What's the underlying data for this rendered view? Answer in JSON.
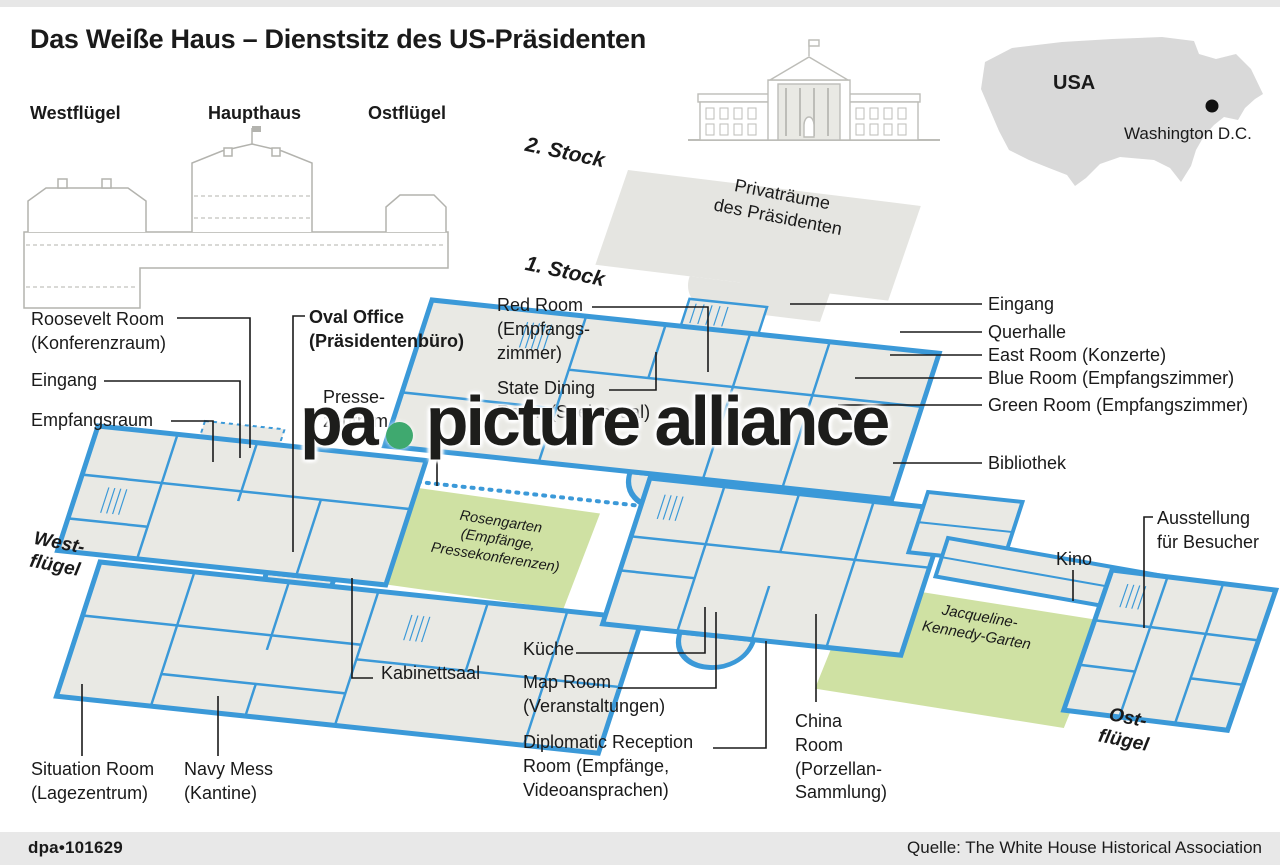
{
  "header": {
    "title": "Das Weiße Haus – Dienstsitz des US-Präsidenten",
    "wings": {
      "west": "Westflügel",
      "main": "Haupthaus",
      "east": "Ostflügel"
    },
    "map": {
      "country": "USA",
      "city": "Washington D.C."
    }
  },
  "floors": {
    "second": "2. Stock",
    "first": "1. Stock",
    "private_rooms": "Privaträume\ndes Präsidenten"
  },
  "rooms": {
    "roosevelt": "Roosevelt Room\n(Konferenzraum)",
    "eingang_west": "Eingang",
    "empfangsraum": "Empfangsraum",
    "oval_office": "Oval Office\n(Präsidentenbüro)",
    "pressezentrum": "Presse-\nzentrum",
    "red_room": "Red Room\n(Empfangs-\nzimmer)",
    "state_dining": "State Dining\nRoom (Speisesaal)",
    "eingang_ost": "Eingang",
    "querhalle": "Querhalle",
    "east_room": "East Room (Konzerte)",
    "blue_room": "Blue Room (Empfangszimmer)",
    "green_room": "Green Room (Empfangszimmer)",
    "bibliothek": "Bibliothek",
    "ausstellung": "Ausstellung\nfür Besucher",
    "kino": "Kino",
    "kabinettsaal": "Kabinettsaal",
    "kueche": "Küche",
    "map_room": "Map Room\n(Veranstaltungen)",
    "diplomatic": "Diplomatic Reception\nRoom (Empfänge,\nVideoansprachen)",
    "china_room": "China\nRoom\n(Porzellan-\nSammlung)",
    "situation_room": "Situation Room\n(Lagezentrum)",
    "navy_mess": "Navy Mess\n(Kantine)",
    "rosengarten": "Rosengarten\n(Empfänge,\nPressekonferenzen)",
    "kennedy_garten": "Jacqueline-\nKennedy-Garten",
    "west_fluegel": "West-\nflügel",
    "ost_fluegel": "Ost-\nflügel"
  },
  "watermark": {
    "part1": "pa",
    "part2": "picture alliance"
  },
  "footer": {
    "id": "dpa•101629",
    "source": "Quelle: The White House Historical Association"
  },
  "colors": {
    "wall_blue": "#3b99d8",
    "plan_fill": "#e9e9e4",
    "garden_green": "#cfe1a3",
    "shape_gray": "#e5e5e1",
    "watermark_green": "#3fa96f"
  }
}
